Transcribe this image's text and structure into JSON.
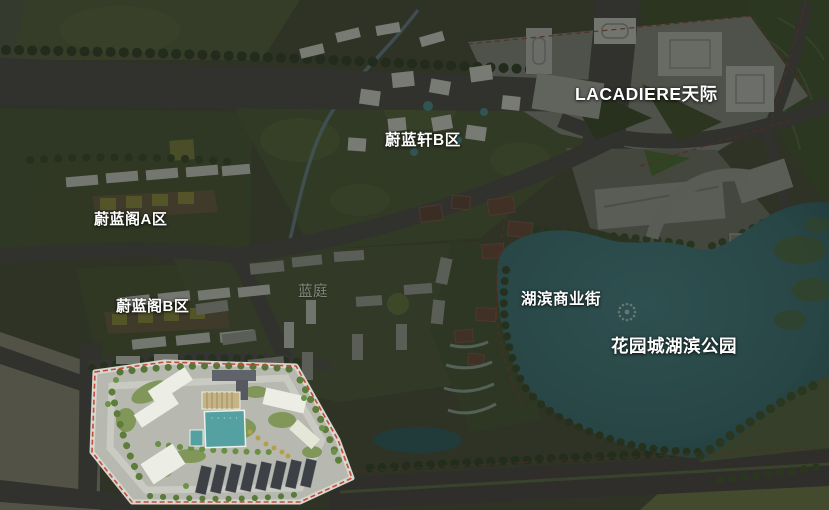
{
  "scene": {
    "description": "Aerial masterplan rendering of a lakeside mixed-use development; most of the plan is dimmed while the lower-left residential compound is shown highlighted with a red dashed parcel boundary.",
    "type": "architectural bird's-eye masterplan rendering"
  },
  "labels": [
    {
      "id": "lacadiere-tianji",
      "text": "LACADIERE天际"
    },
    {
      "id": "weilanxuan-b",
      "text": "蔚蓝轩B区"
    },
    {
      "id": "weilange-a",
      "text": "蔚蓝阁A区"
    },
    {
      "id": "weilange-b",
      "text": "蔚蓝阁B区"
    },
    {
      "id": "lanting",
      "text": "蓝庭"
    },
    {
      "id": "hubin-shangyejie",
      "text": "湖滨商业街"
    },
    {
      "id": "huayuancheng-hubin-gongyuan",
      "text": "花园城湖滨公园"
    }
  ],
  "colors": {
    "label_text": "#ffffff",
    "lake_water": "#3c6f72",
    "road_asphalt": "#4f4b48",
    "greenery_dim": "#4c5639",
    "highlight_ground": "#b7b8b0",
    "pool_water": "#55a1a2",
    "boundary_dash_red": "#c0473a",
    "bare_land_tan": "#8b8674",
    "dim_overlay": "rgba(13,18,13,0.44)"
  }
}
